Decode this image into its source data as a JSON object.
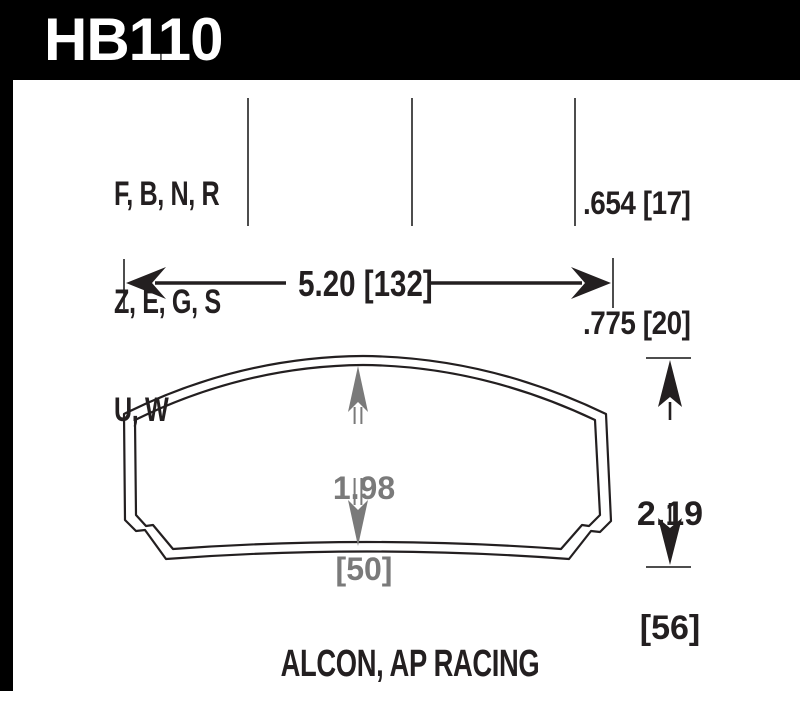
{
  "colors": {
    "banner_background": "#000000",
    "ink": "#231f20",
    "dimension_gray": "#7a7a7a",
    "line_gray": "#4d4d4d",
    "background": "#ffffff"
  },
  "banner": {
    "part_number": "HB110"
  },
  "spec_header": {
    "compound_lines": [
      "F, B, N, R",
      "Z, E, G, S",
      "U, W"
    ],
    "thickness_lines": [
      ".654 [17]",
      ".775 [20]"
    ]
  },
  "dimensions": {
    "overall_width": {
      "label": "5.20 [132]"
    },
    "pad_height_center": {
      "value_in": "1.98",
      "value_mm": "[50]"
    },
    "overall_height": {
      "value_in": "2.19",
      "value_mm": "[56]"
    }
  },
  "footer": {
    "applications": "ALCON, AP RACING"
  }
}
